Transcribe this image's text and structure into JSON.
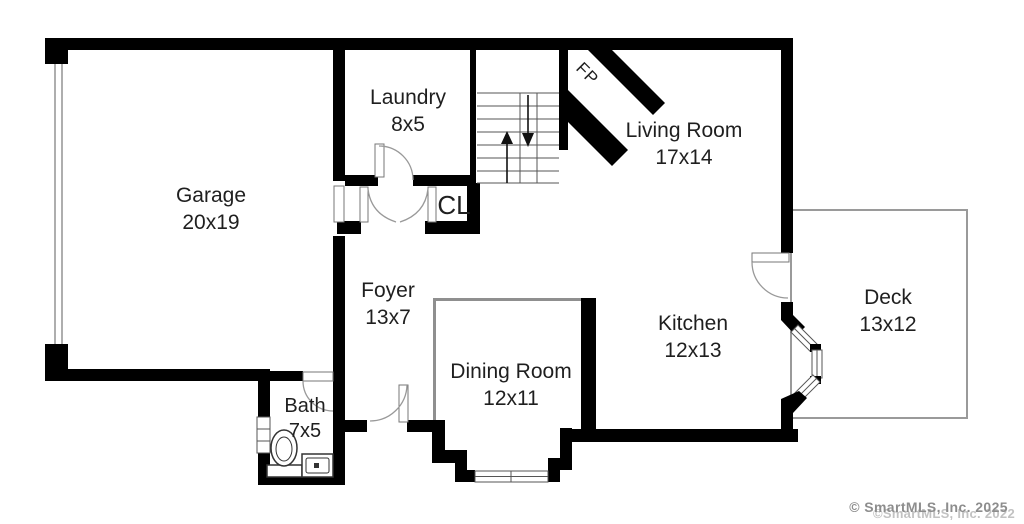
{
  "plan": {
    "rooms": [
      {
        "id": "garage",
        "name": "Garage",
        "dims": "20x19"
      },
      {
        "id": "laundry",
        "name": "Laundry",
        "dims": "8x5"
      },
      {
        "id": "living-room",
        "name": "Living Room",
        "dims": "17x14"
      },
      {
        "id": "foyer",
        "name": "Foyer",
        "dims": "13x7"
      },
      {
        "id": "kitchen",
        "name": "Kitchen",
        "dims": "12x13"
      },
      {
        "id": "dining-room",
        "name": "Dining Room",
        "dims": "12x11"
      },
      {
        "id": "deck",
        "name": "Deck",
        "dims": "13x12"
      },
      {
        "id": "bath",
        "name": "Bath",
        "dims": "7x5"
      }
    ],
    "labels": {
      "closet": "CL",
      "fireplace": "FP"
    },
    "watermark": {
      "primary": "© SmartMLS, Inc. 2025",
      "secondary": "©SmartMLS, Inc. 2022"
    },
    "colors": {
      "wall": "#000000",
      "partition": "#8f8f8f",
      "deck_outline": "#9a9a9a",
      "garage_thin": "#9a9a9a",
      "window_stroke": "#555555",
      "door_arc": "#999999",
      "stair_line": "#555555",
      "label_text": "#1f1f1f",
      "watermark": "#8d8d8d",
      "watermark_light": "#c2c2c2"
    }
  }
}
